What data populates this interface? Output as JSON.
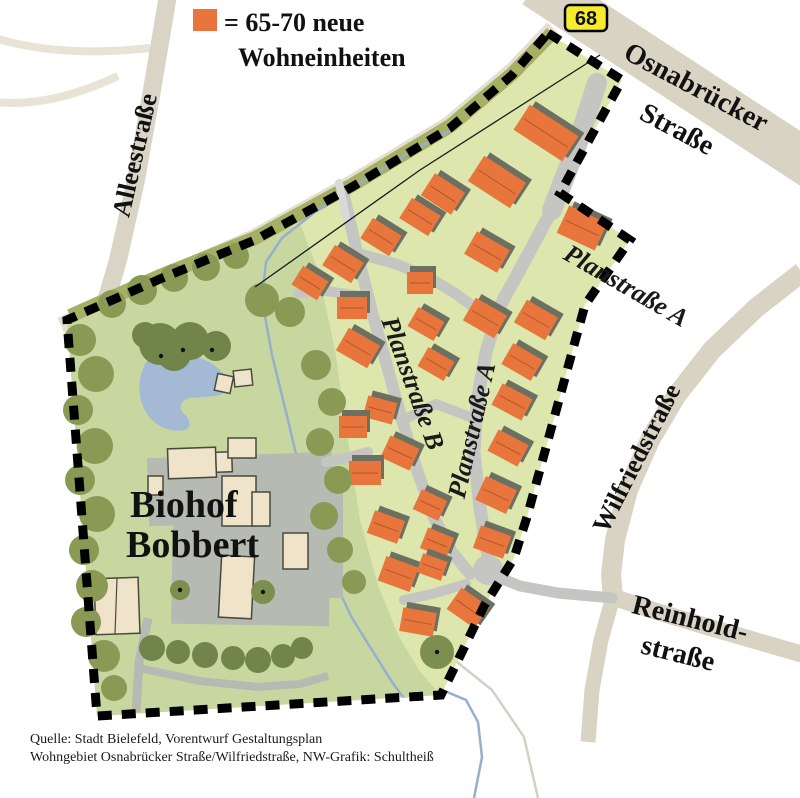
{
  "legend": {
    "swatch_color": "#e8753b",
    "line1": "= 65-70 neue",
    "line2": "Wohneinheiten"
  },
  "route_badge": {
    "number": "68",
    "bg": "#f6ec2d"
  },
  "streets": {
    "osnabruecker_line1": "Osnabrücker",
    "osnabruecker_line2": "Straße",
    "alleestrasse": "Alleestraße",
    "planstrasse_a_upper": "Planstraße A",
    "planstrasse_a_central": "Planstraße A",
    "planstrasse_b": "Planstraße B",
    "wilfriedstrasse": "Wilfriedstraße",
    "reinholdstrasse_line1": "Reinhold-",
    "reinholdstrasse_line2": "straße"
  },
  "site": {
    "farm_label_line1": "Biohof",
    "farm_label_line2": "Bobbert"
  },
  "source": {
    "line1": "Quelle: Stadt Bielefeld, Vorentwurf Gestaltungsplan",
    "line2": "Wohngebiet Osnabrücker Straße/Wilfriedstraße, NW-Grafik: Schultheiß"
  },
  "colors": {
    "house": "#e8753b",
    "house_shadow": "#6b7061",
    "site_green": "#dde6ad",
    "park_green": "#c8d7a0",
    "tree_green": "#8a9a55",
    "tree_dark": "#71854a",
    "tree_mid": "#7d8f4f",
    "road_gray": "#c5c6c2",
    "yard_gray": "#b7bab2",
    "outer_road_beige": "#dbd5c5",
    "water_blue": "#a3b9d4",
    "stream_blue": "#96afcd",
    "boundary": "#000000",
    "farm_building": "#efe3ca",
    "badge_yellow": "#f6ec2d"
  },
  "map_features": {
    "houses": [
      [
        546,
        133,
        58,
        30,
        33
      ],
      [
        497,
        182,
        50,
        30,
        33
      ],
      [
        443,
        194,
        36,
        26,
        33
      ],
      [
        582,
        228,
        42,
        30,
        25
      ],
      [
        420,
        217,
        34,
        24,
        32
      ],
      [
        381,
        237,
        34,
        24,
        32
      ],
      [
        343,
        264,
        34,
        24,
        32
      ],
      [
        310,
        283,
        30,
        22,
        32
      ],
      [
        487,
        252,
        38,
        26,
        30
      ],
      [
        485,
        318,
        36,
        26,
        30
      ],
      [
        420,
        283,
        26,
        22,
        0
      ],
      [
        352,
        308,
        30,
        22,
        0
      ],
      [
        358,
        348,
        36,
        26,
        30
      ],
      [
        536,
        320,
        36,
        26,
        30
      ],
      [
        522,
        362,
        34,
        24,
        30
      ],
      [
        512,
        402,
        34,
        24,
        28
      ],
      [
        508,
        448,
        34,
        24,
        28
      ],
      [
        496,
        495,
        34,
        26,
        25
      ],
      [
        492,
        542,
        32,
        24,
        20
      ],
      [
        426,
        324,
        30,
        22,
        30
      ],
      [
        436,
        364,
        30,
        22,
        30
      ],
      [
        380,
        410,
        30,
        22,
        15
      ],
      [
        353,
        427,
        28,
        22,
        0
      ],
      [
        400,
        453,
        32,
        24,
        25
      ],
      [
        365,
        473,
        32,
        24,
        0
      ],
      [
        386,
        527,
        32,
        24,
        20
      ],
      [
        430,
        505,
        28,
        22,
        25
      ],
      [
        437,
        543,
        28,
        22,
        22
      ],
      [
        398,
        574,
        34,
        26,
        20
      ],
      [
        432,
        567,
        26,
        20,
        20
      ],
      [
        468,
        608,
        34,
        26,
        35
      ],
      [
        418,
        622,
        34,
        24,
        10
      ]
    ],
    "trees": [
      [
        80,
        340,
        16,
        0
      ],
      [
        96,
        374,
        18,
        0
      ],
      [
        78,
        410,
        15,
        0
      ],
      [
        95,
        446,
        18,
        0
      ],
      [
        80,
        480,
        15,
        0
      ],
      [
        97,
        514,
        18,
        0
      ],
      [
        84,
        550,
        15,
        0
      ],
      [
        92,
        586,
        16,
        0
      ],
      [
        86,
        622,
        15,
        0
      ],
      [
        104,
        656,
        16,
        0
      ],
      [
        114,
        688,
        13,
        0
      ],
      [
        112,
        304,
        14,
        0
      ],
      [
        142,
        290,
        15,
        0
      ],
      [
        174,
        278,
        14,
        0
      ],
      [
        206,
        267,
        14,
        0
      ],
      [
        236,
        256,
        13,
        0
      ],
      [
        262,
        300,
        17,
        0
      ],
      [
        290,
        312,
        15,
        0
      ],
      [
        160,
        344,
        21,
        1
      ],
      [
        190,
        341,
        19,
        1
      ],
      [
        216,
        346,
        15,
        1
      ],
      [
        174,
        354,
        17,
        1
      ],
      [
        145,
        335,
        13,
        1
      ],
      [
        316,
        365,
        15,
        0
      ],
      [
        332,
        402,
        14,
        0
      ],
      [
        320,
        442,
        14,
        0
      ],
      [
        338,
        480,
        14,
        0
      ],
      [
        324,
        516,
        14,
        0
      ],
      [
        340,
        550,
        13,
        0
      ],
      [
        354,
        582,
        12,
        0
      ],
      [
        152,
        648,
        13,
        1
      ],
      [
        178,
        652,
        12,
        1
      ],
      [
        205,
        655,
        13,
        1
      ],
      [
        233,
        658,
        12,
        1
      ],
      [
        258,
        660,
        13,
        1
      ],
      [
        283,
        656,
        12,
        1
      ],
      [
        302,
        648,
        11,
        1
      ],
      [
        437,
        652,
        17,
        2
      ],
      [
        180,
        590,
        10,
        2
      ],
      [
        263,
        592,
        12,
        2
      ]
    ],
    "tree_dots": [
      [
        161,
        356
      ],
      [
        183,
        350
      ],
      [
        212,
        350
      ],
      [
        437,
        652
      ],
      [
        180,
        590
      ],
      [
        263,
        592
      ]
    ]
  }
}
